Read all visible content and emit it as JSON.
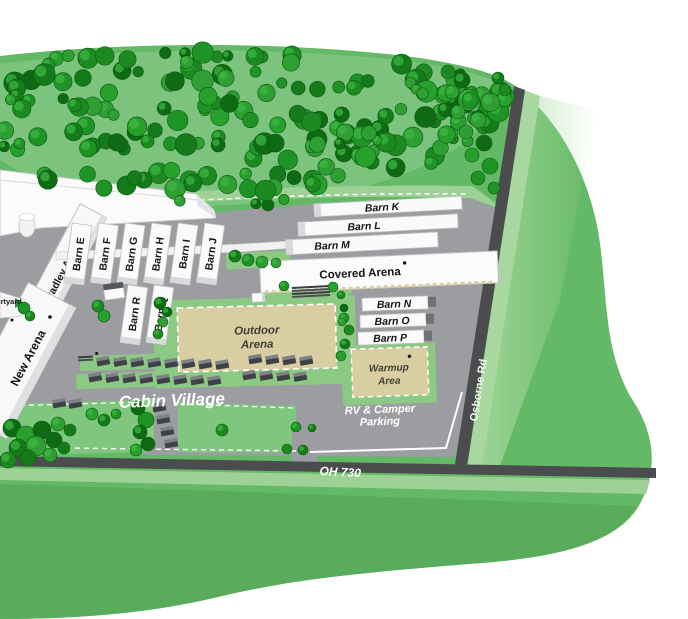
{
  "map": {
    "arenas": {
      "new_arena": "New Arena",
      "bradley_arena": "Bradley Arena",
      "covered_arena": "Covered Arena",
      "outdoor_line1": "Outdoor",
      "outdoor_line2": "Arena",
      "warmup_line1": "Warmup",
      "warmup_line2": "Area"
    },
    "barns": {
      "row": [
        "Barn E",
        "Barn F",
        "Barn G",
        "Barn H",
        "Barn I",
        "Barn J"
      ],
      "rq": [
        "Barn R",
        "Barn Q"
      ],
      "klm": [
        "Barn K",
        "Barn L",
        "Barn M"
      ],
      "nop": [
        "Barn N",
        "Barn O",
        "Barn P"
      ]
    },
    "areas": {
      "cabin_village": "Cabin Village",
      "rv_line1": "RV & Camper",
      "rv_line2": "Parking",
      "courtyard": "Courtyard"
    },
    "roads": {
      "oh730": "OH 730",
      "osborne": "Osborne Rd"
    },
    "colors": {
      "grass_main": "#64b966",
      "grass_dark": "#58ac5c",
      "grass_light": "#8cca83",
      "verge_light": "#9ed195",
      "forest_base": "#7cc47e",
      "tree_greens": [
        "#1c8a21",
        "#157a1a",
        "#27a02c",
        "#0e6b13",
        "#1f9426",
        "#2f9e33"
      ],
      "pavement": "#9b9da0",
      "road": "#4a4c4e",
      "building": "#fafafa",
      "building_edge": "#bcbdbf",
      "arena_tan": "#d9cda2",
      "label_dark": "#141414",
      "label_white": "#ffffff"
    }
  }
}
